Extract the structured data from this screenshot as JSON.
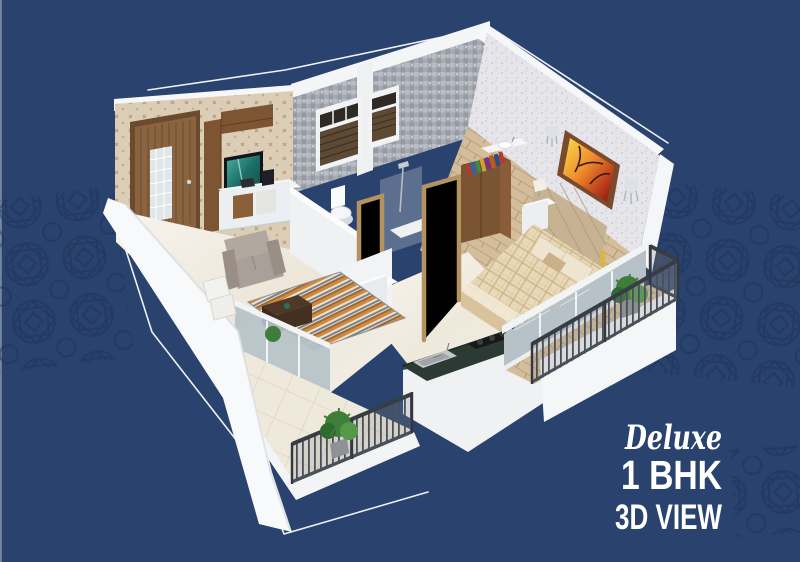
{
  "poster": {
    "background_color": "#2a426e",
    "pattern_color": "#1d3258",
    "outline_color": "#ffffff",
    "edge_line_color": "#98a2b5",
    "caption": {
      "script_line": "Deluxe",
      "headline": "1 BHK",
      "subline": "3D VIEW",
      "color": "#ffffff"
    },
    "scene": {
      "type": "isometric-3d-floor-plan",
      "rooms": [
        "living-room",
        "toilet",
        "shower-bath",
        "kitchen",
        "bedroom",
        "balcony-left",
        "balcony-right"
      ],
      "furniture": [
        "entry-door",
        "tv",
        "tv-unit",
        "sofa",
        "cushions",
        "striped-rug",
        "coffee-table",
        "toilet-seat",
        "shower-set",
        "wooden-door-frames",
        "wash-basin",
        "wardrobe",
        "double-bed",
        "tufted-headboard",
        "nightstand",
        "table-lamp",
        "wall-painting",
        "wall-sconces",
        "kitchen-counter",
        "steel-sink",
        "gas-stove",
        "balcony-railing",
        "potted-plants",
        "sliding-glass-windows",
        "window-blinds",
        "towel"
      ]
    }
  }
}
